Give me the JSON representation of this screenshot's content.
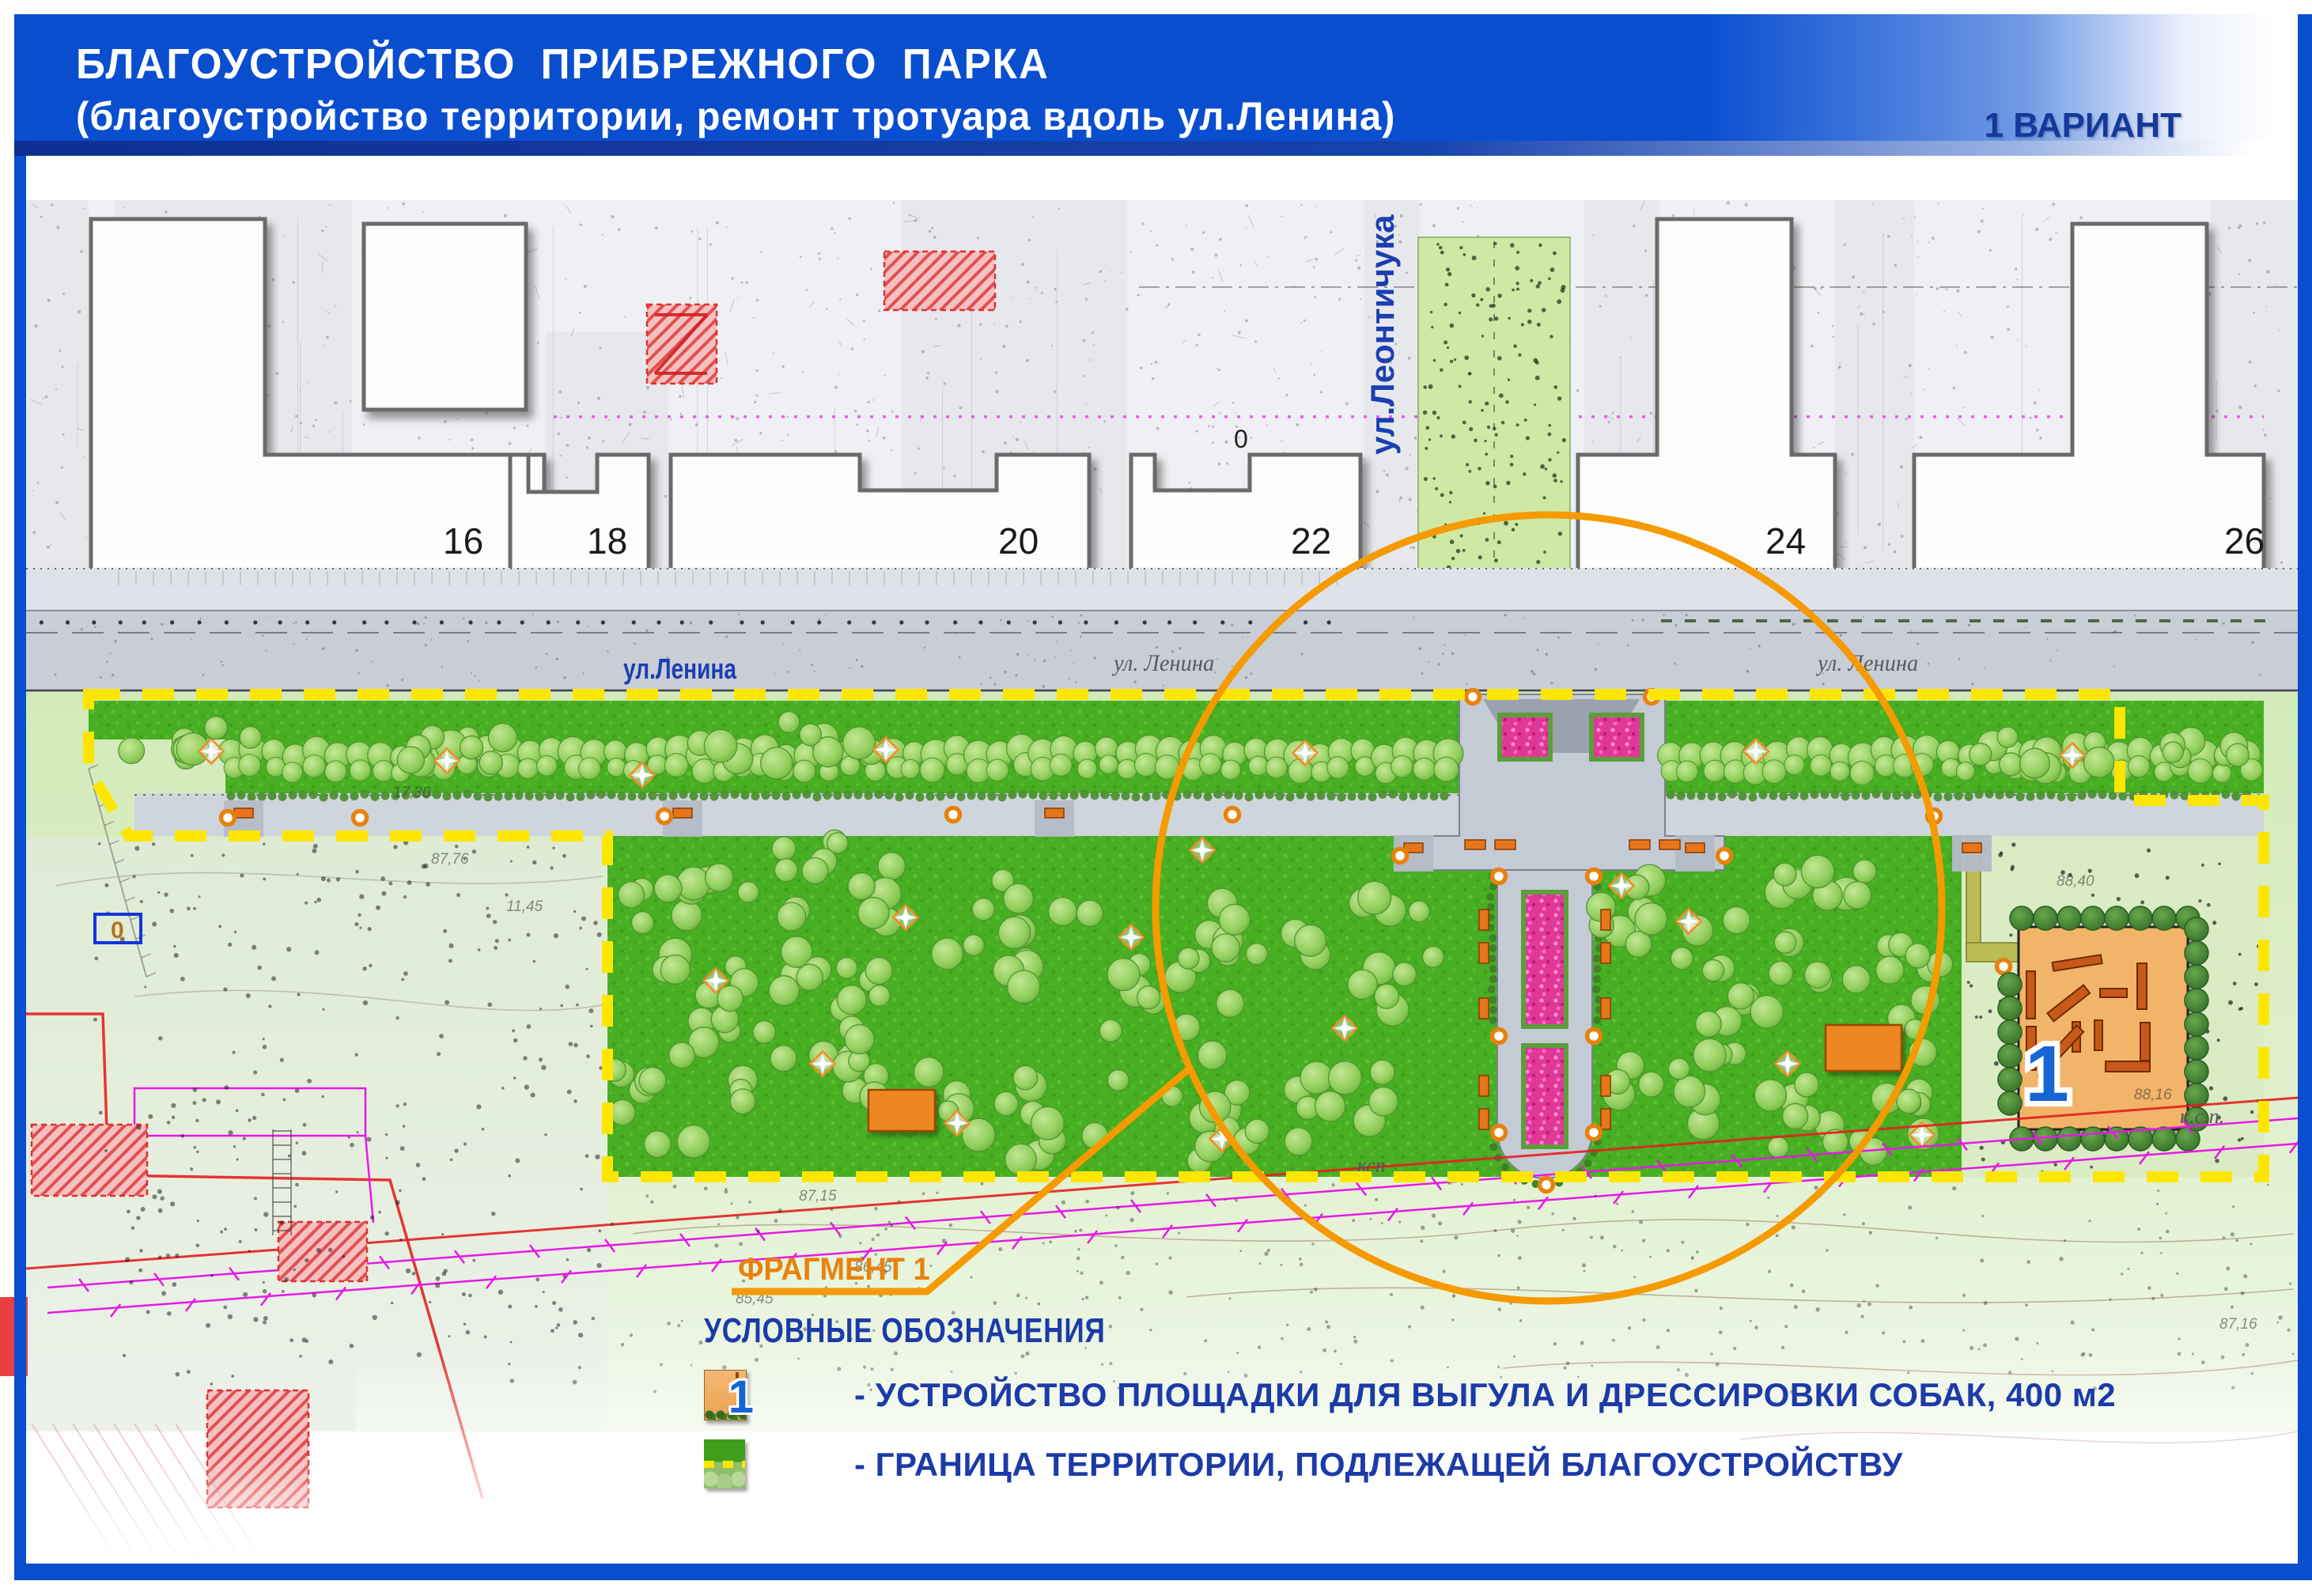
{
  "header": {
    "title_line1": "БЛАГОУСТРОЙСТВО  ПРИБРЕЖНОГО  ПАРКА",
    "title_line2": "(благоустройство территории, ремонт тротуара вдоль ул.Ленина)",
    "variant_label": "1 ВАРИАНТ"
  },
  "map": {
    "buildings": [
      "16",
      "18",
      "20",
      "22",
      "24",
      "26"
    ],
    "streets": {
      "lenina_label": "ул.Ленина",
      "lenina_topo_label_1": "ул. Ленина",
      "lenina_topo_label_2": "ул. Ленина",
      "leontichuka_label": "ул.Леонтичука"
    },
    "fragment_label": "ФРАГМЕНТ 1",
    "dog_park_number": "1",
    "topo_labels": {
      "ksp_1": "ксп",
      "ksp_2": "к.с.п.",
      "zero_box": "0",
      "zero_topo": "0"
    },
    "elevations": [
      "87,76",
      "17,30",
      "11,45",
      "87,15",
      "86,45",
      "85,45",
      "88,40",
      "88,16",
      "87,16"
    ]
  },
  "legend": {
    "heading": "УСЛОВНЫЕ ОБОЗНАЧЕНИЯ",
    "items": [
      {
        "icon": "dog-park-icon",
        "badge": "1",
        "label": "- УСТРОЙСТВО ПЛОЩАДКИ ДЛЯ ВЫГУЛА И ДРЕССИРОВКИ СОБАК, 400 м2"
      },
      {
        "icon": "territory-boundary-icon",
        "badge": "",
        "label": "- ГРАНИЦА ТЕРРИТОРИИ, ПОДЛЕЖАЩЕЙ БЛАГОУСТРОЙСТВУ"
      }
    ]
  },
  "colors": {
    "header_blue": "#0A4ED0",
    "variant_blue": "#15389B",
    "legend_blue": "#1C3BA8",
    "accent_orange": "#F59A00",
    "boundary_yellow": "#FFE600",
    "lawn_green": "#48AE22",
    "flower_pink": "#E03898",
    "dog_park_orange": "#F2B469"
  }
}
